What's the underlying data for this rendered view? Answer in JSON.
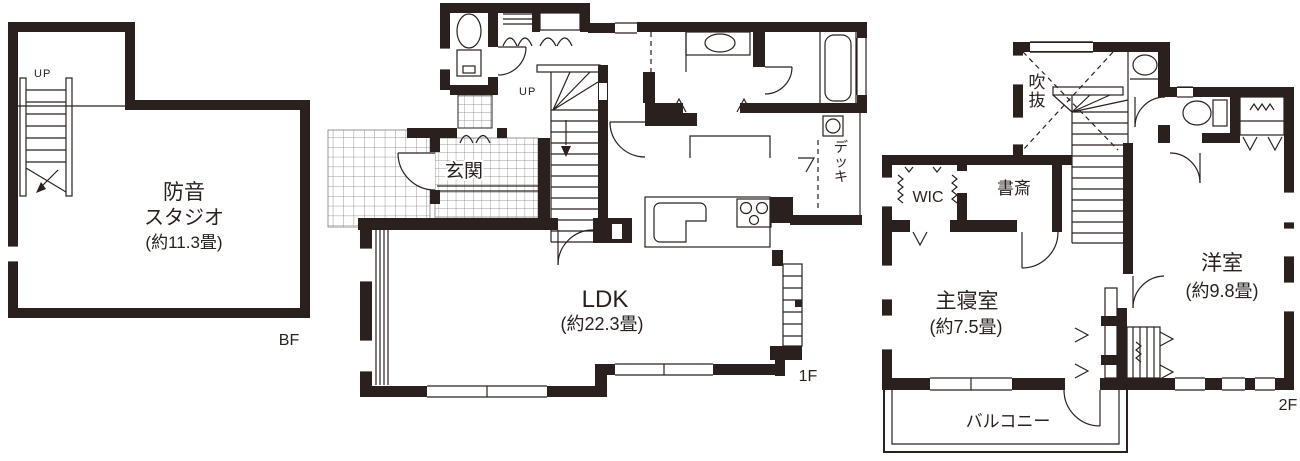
{
  "colors": {
    "wall": "#2a211e",
    "line": "#2a211e",
    "tile_grid": "#7d7d7d",
    "background": "#ffffff"
  },
  "floors": {
    "bf": {
      "tag": "BF",
      "stair_label": "UP",
      "studio_name_line1": "防音",
      "studio_name_line2": "スタジオ",
      "studio_size": "(約11.3畳)"
    },
    "f1": {
      "tag": "1F",
      "stair_label": "UP",
      "entrance_label": "玄関",
      "ldk_name": "LDK",
      "ldk_size": "(約22.3畳)",
      "deck_label": "デッキ"
    },
    "f2": {
      "tag": "2F",
      "void_label": "吹抜",
      "wic_label": "WIC",
      "study_label": "書斎",
      "master_name": "主寝室",
      "master_size": "(約7.5畳)",
      "western_name": "洋室",
      "western_size": "(約9.8畳)",
      "balcony_label": "バルコニー"
    }
  }
}
